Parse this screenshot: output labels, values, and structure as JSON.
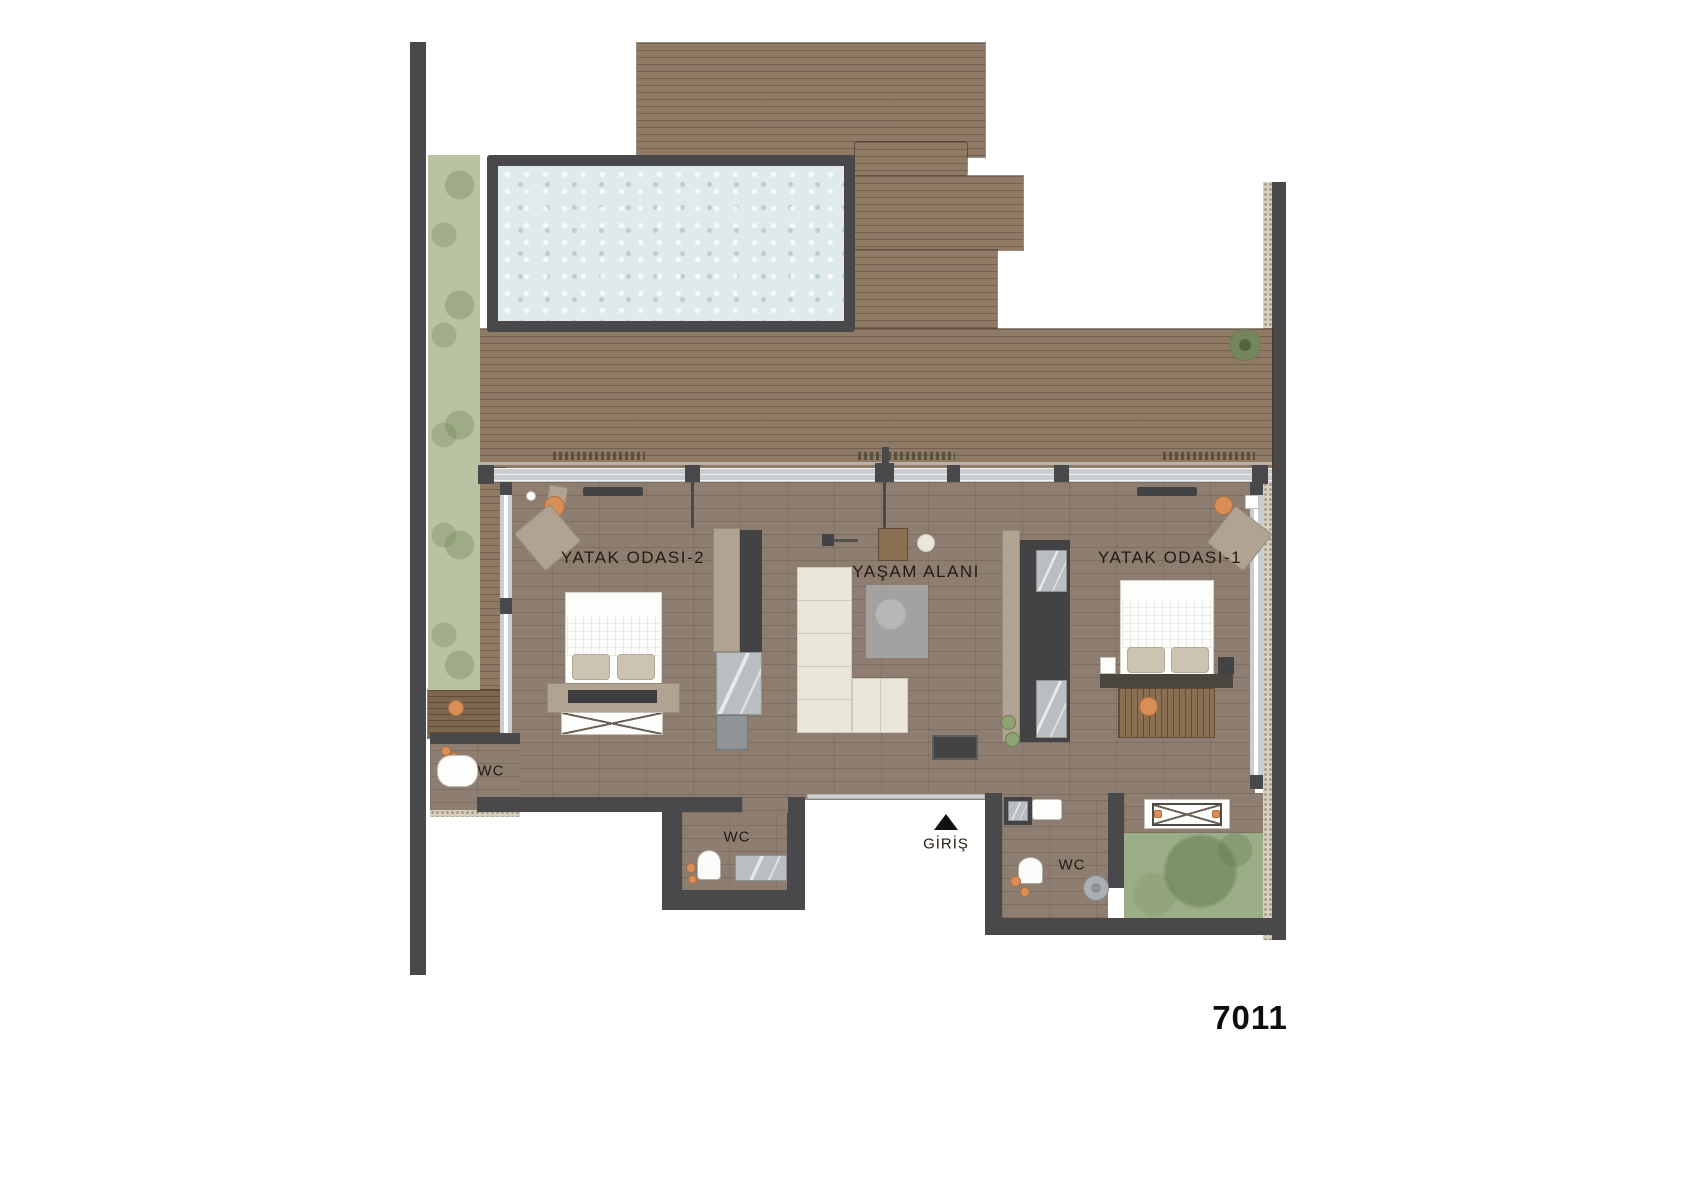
{
  "unit": {
    "number": "7011"
  },
  "rooms": {
    "bedroom2": {
      "label": "YATAK ODASI-2"
    },
    "living": {
      "label": "YAŞAM ALANI"
    },
    "bedroom1": {
      "label": "YATAK ODASI-1"
    }
  },
  "wc": {
    "left": "WC",
    "middle": "WC",
    "right": "WC"
  },
  "entrance": {
    "label": "GİRİŞ"
  },
  "colors": {
    "wall": "#49494b",
    "deck": "#8f7a66",
    "deck_dark": "#7e6751",
    "floor": "#8d7e71",
    "glass": "#c9cdcf",
    "grass": "#b9c2a3",
    "garden": "#9cae88",
    "water": "#e0eaec",
    "cream": "#eae6da",
    "taupe": "#b0a392",
    "orange": "#d98e57",
    "marble": "#b9bec0",
    "wood": "#8a6f52",
    "plant": "#8fa472",
    "ink": "#241b10",
    "unit": "#0d0d0d"
  }
}
